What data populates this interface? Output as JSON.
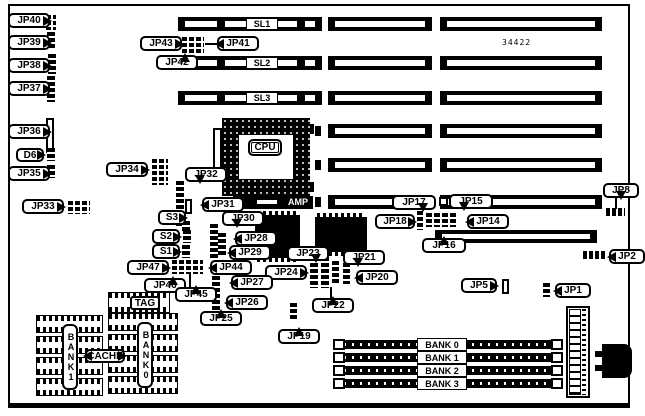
{
  "diagram": {
    "part_number": "34422",
    "cpu_label": "CPU",
    "cpu_socket_brand": "AMP",
    "slots": {
      "sl1": "SL1",
      "sl2": "SL2",
      "sl3": "SL3"
    },
    "simm_banks": [
      "BANK 0",
      "BANK 1",
      "BANK 2",
      "BANK 3"
    ],
    "cache": {
      "label": "CACHE",
      "tag": "TAG",
      "bank0": "BANK0",
      "bank1": "BANK1"
    },
    "switches": {
      "s1": "S1",
      "s2": "S2",
      "s3": "S3"
    },
    "diode": {
      "d6": "D6"
    },
    "jumpers": {
      "jp1": "JP1",
      "jp2": "JP2",
      "jp5": "JP5",
      "jp8": "JP8",
      "jp14": "JP14",
      "jp15": "JP15",
      "jp16": "JP16",
      "jp17": "JP17",
      "jp18": "JP18",
      "jp19": "JP19",
      "jp20": "JP20",
      "jp21": "JP21",
      "jp22": "JP22",
      "jp23": "JP23",
      "jp24": "JP24",
      "jp25": "JP25",
      "jp26": "JP26",
      "jp27": "JP27",
      "jp28": "JP28",
      "jp29": "JP29",
      "jp30": "JP30",
      "jp31": "JP31",
      "jp32": "JP32",
      "jp33": "JP33",
      "jp34": "JP34",
      "jp35": "JP35",
      "jp36": "JP36",
      "jp37": "JP37",
      "jp38": "JP38",
      "jp39": "JP39",
      "jp40": "JP40",
      "jp41": "JP41",
      "jp42": "JP42",
      "jp43": "JP43",
      "jp44": "JP44",
      "jp45": "JP45",
      "jp46": "JP46",
      "jp47": "JP47"
    }
  }
}
